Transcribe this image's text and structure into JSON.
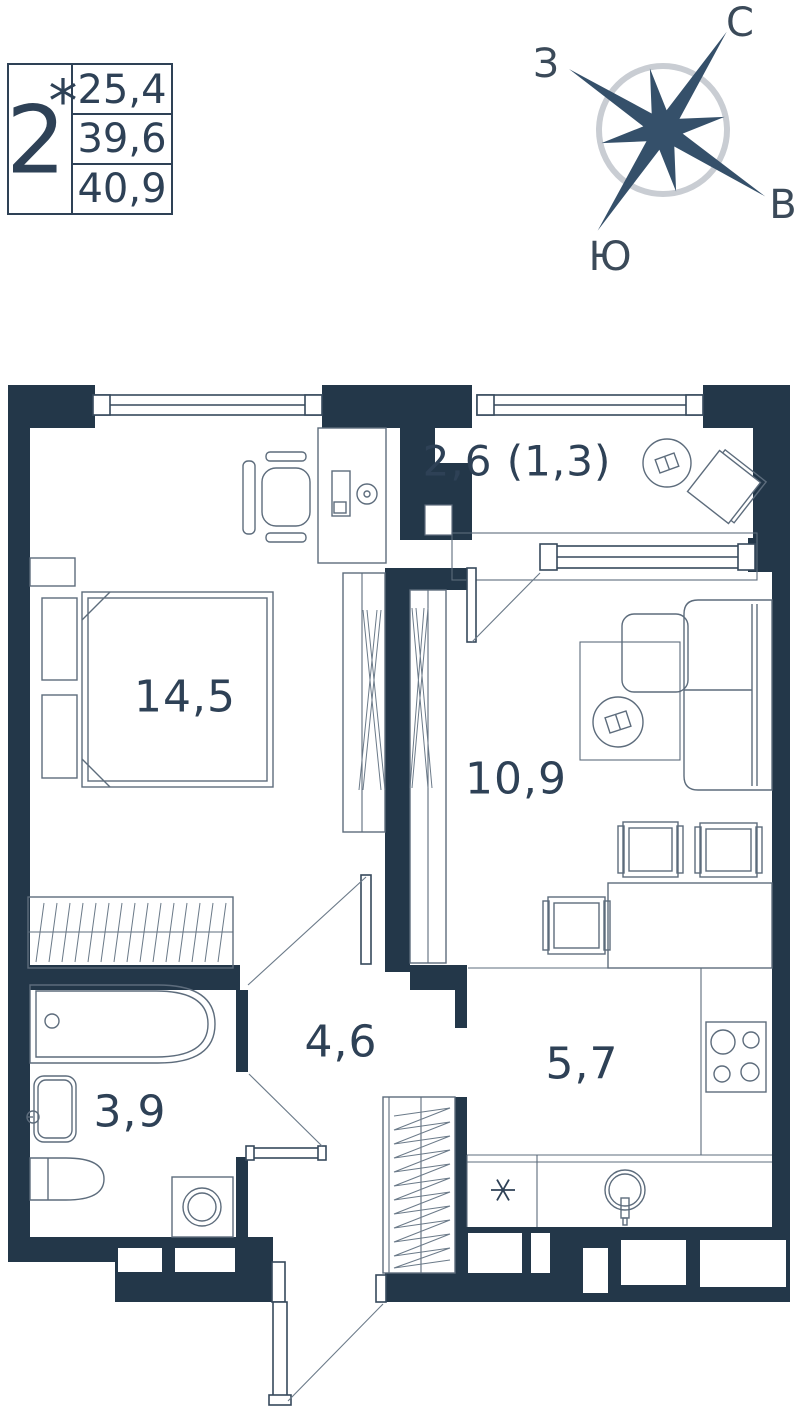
{
  "info_box": {
    "room_count": "2",
    "superscript": "*",
    "values": [
      "25,4",
      "39,6",
      "40,9"
    ]
  },
  "compass": {
    "north": "С",
    "east": "В",
    "south": "Ю",
    "west": "З"
  },
  "rooms": {
    "bedroom": {
      "area": "14,5"
    },
    "living": {
      "area": "10,9"
    },
    "balcony": {
      "area": "2,6 (1,3)"
    },
    "hallway": {
      "area": "4,6"
    },
    "kitchen": {
      "area": "5,7",
      "appliance_marker": "*"
    },
    "bathroom": {
      "area": "3,9"
    }
  },
  "colors": {
    "wall": "#233749",
    "ink": "#2e4156",
    "line": "#5d6c7c",
    "compass_ring": "#c9cdd3",
    "star": "#35506a"
  }
}
